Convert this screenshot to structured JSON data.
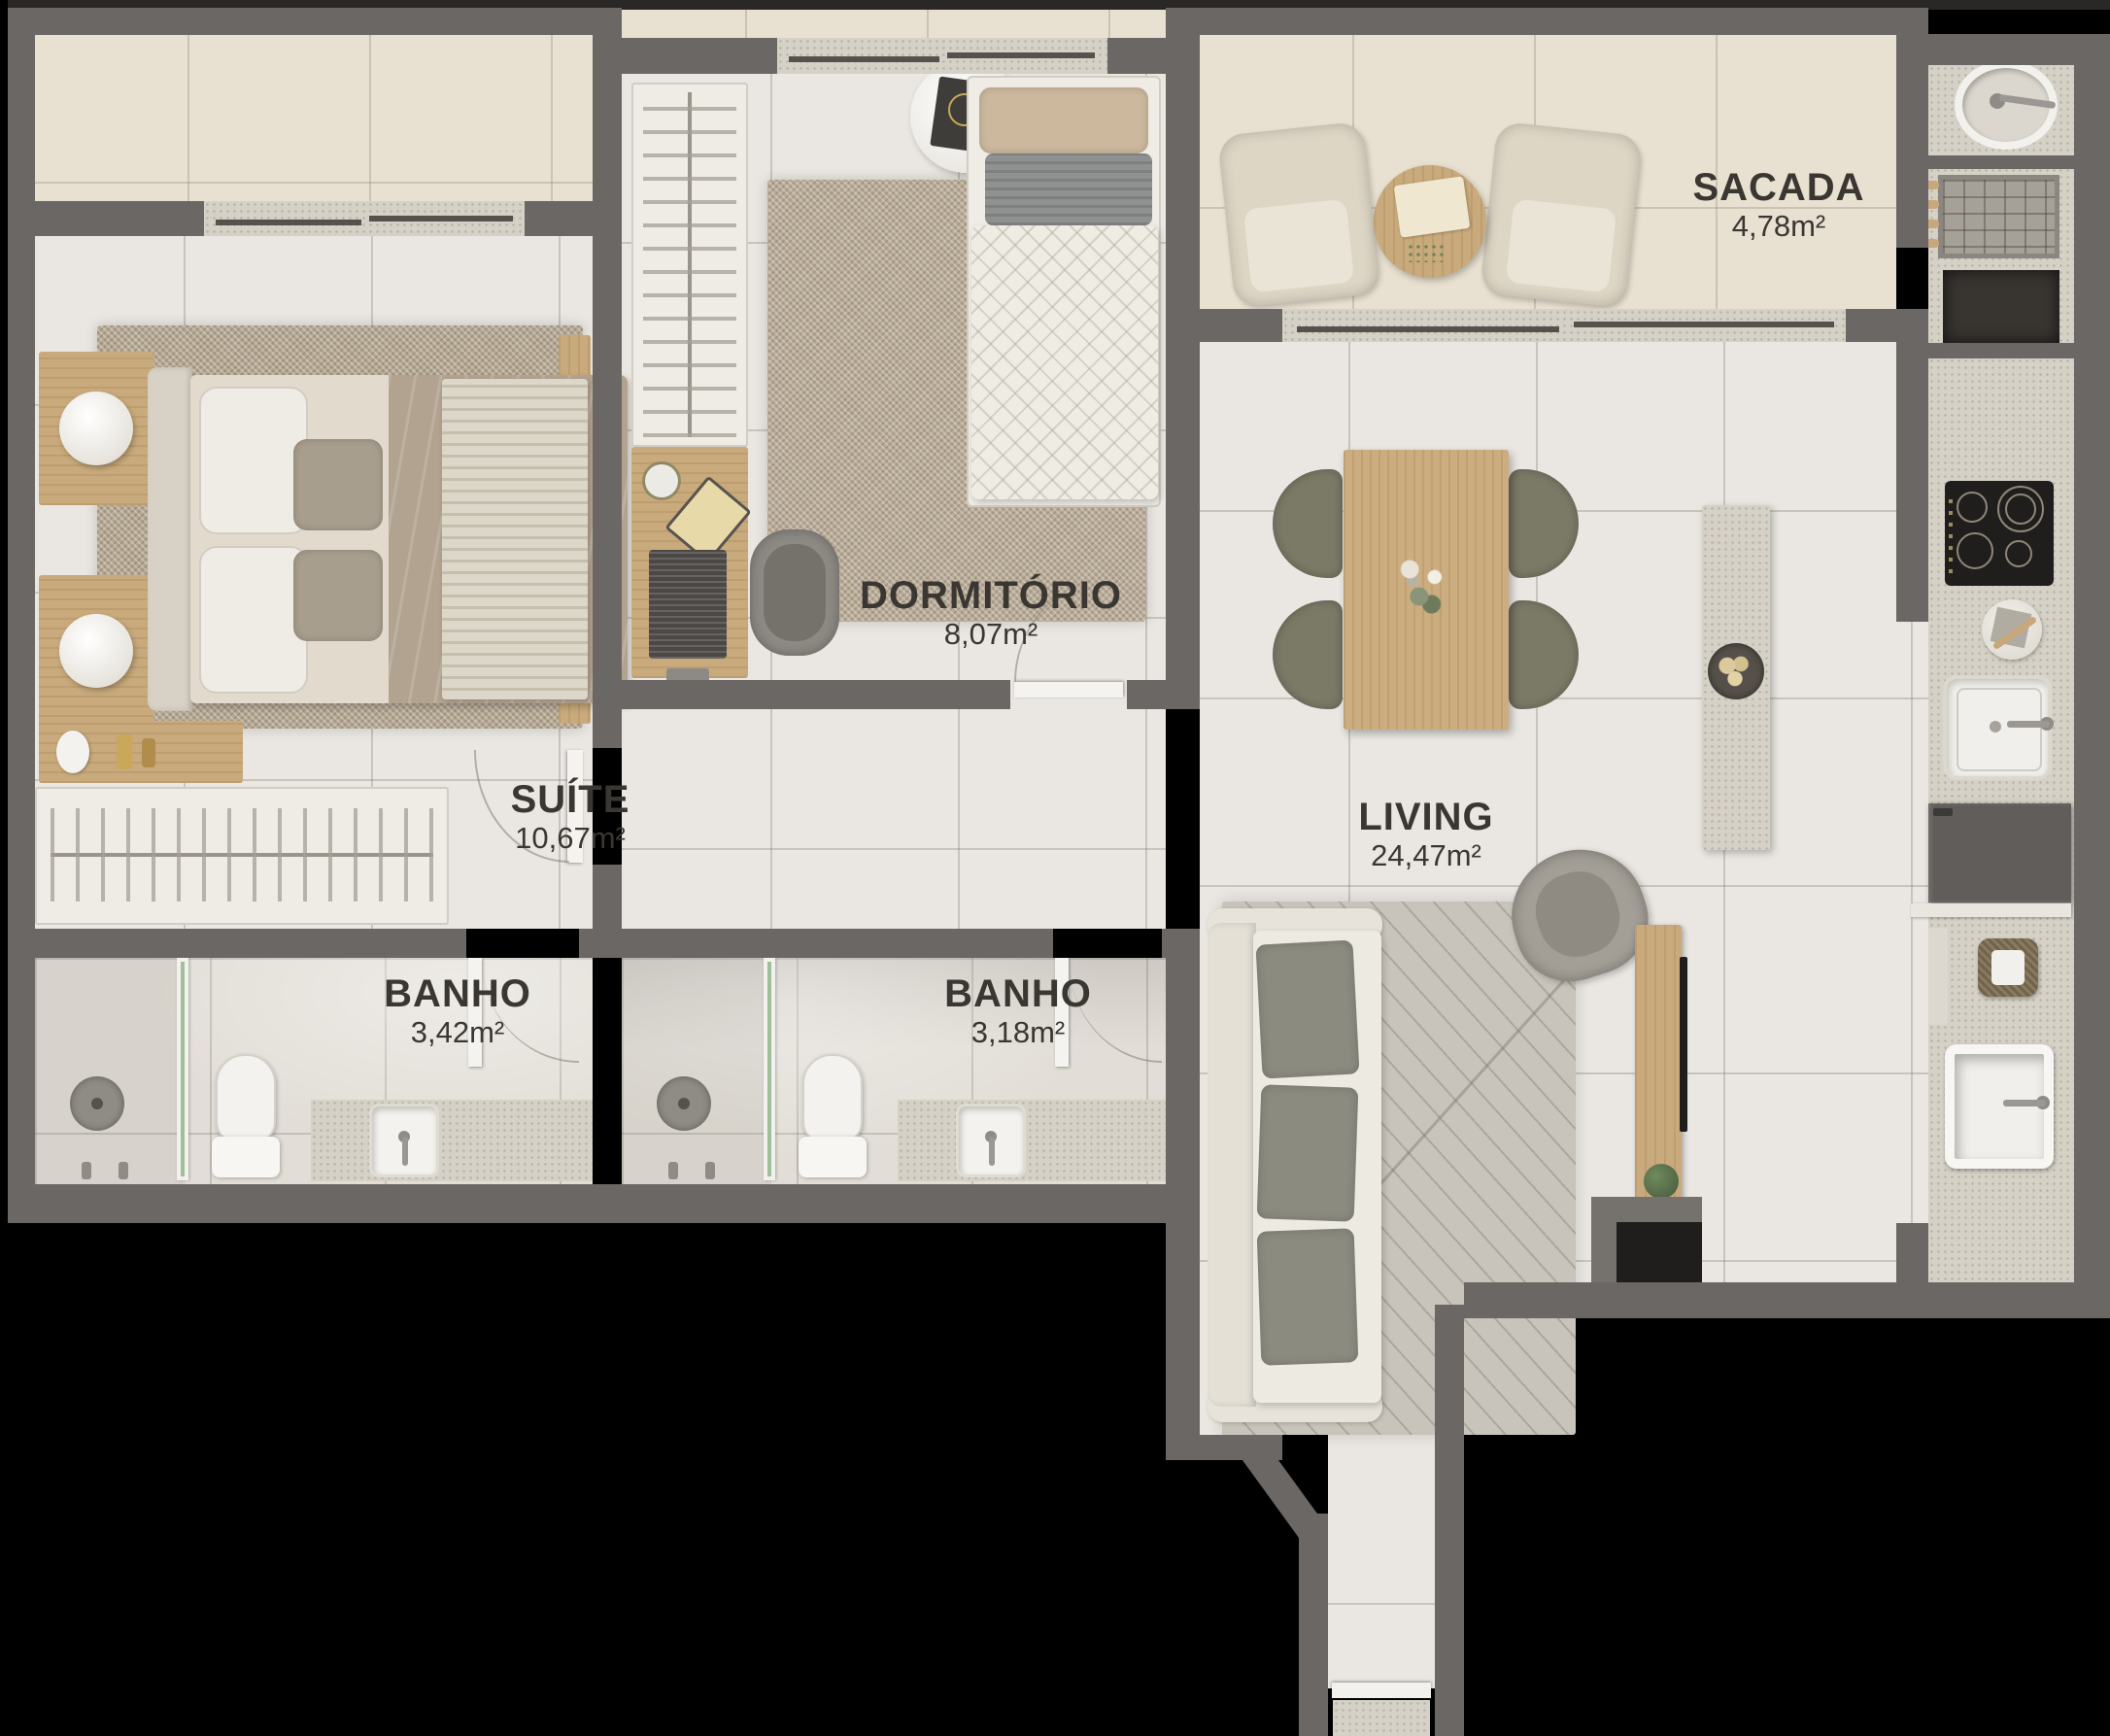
{
  "plan": {
    "type": "apartment-floor-plan",
    "style": "top-down-3d-render",
    "background_color": "#000000",
    "wall_color": "#6b6765",
    "floor_interior_color": "#eae7e2",
    "floor_balcony_color": "#e8e1d1",
    "label_color": "#3a3733",
    "rooms": [
      {
        "id": "sacada",
        "name": "SACADA",
        "area": "4,78m²"
      },
      {
        "id": "dormitorio",
        "name": "DORMITÓRIO",
        "area": "8,07m²"
      },
      {
        "id": "suite",
        "name": "SUÍTE",
        "area": "10,67m²"
      },
      {
        "id": "living",
        "name": "LIVING",
        "area": "24,47m²"
      },
      {
        "id": "banho-suite",
        "name": "BANHO",
        "area": "3,42m²"
      },
      {
        "id": "banho-social",
        "name": "BANHO",
        "area": "3,18m²"
      }
    ],
    "furniture": [
      "double-bed",
      "nightstand-lamps",
      "suite-wardrobe-hangers",
      "suite-dresser",
      "suite-tv-panel",
      "single-bed",
      "desk-with-laptop",
      "office-chair",
      "round-side-table",
      "bedroom-wardrobe-hangers",
      "balcony-armchairs",
      "balcony-coffee-table",
      "dining-table-flowers",
      "dining-chairs",
      "kitchen-island",
      "sofa",
      "living-rug",
      "armchair",
      "tv-sideboard",
      "plant",
      "cooktop",
      "kitchen-sink",
      "fridge",
      "laundry-round-sink",
      "drying-rack",
      "laundry-deep-sink",
      "laundry-basket",
      "shower",
      "toilet",
      "vanity-sink",
      "shower-glass-partition",
      "doors",
      "windows",
      "entry-door",
      "doormat"
    ]
  }
}
